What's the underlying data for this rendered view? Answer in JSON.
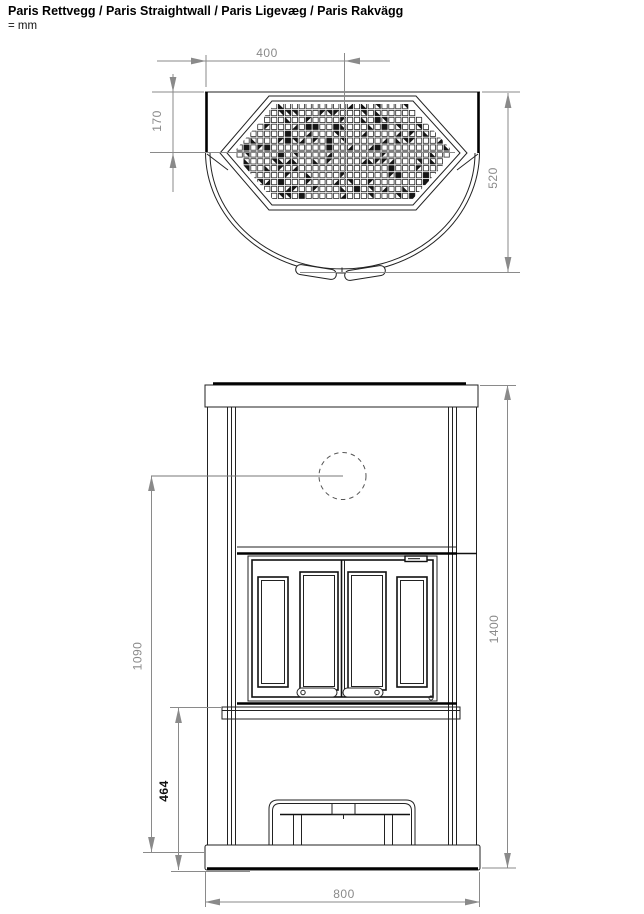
{
  "title": "Paris Rettvegg / Paris Straightwall / Paris Ligevæg / Paris Rakvägg",
  "unit_note": "= mm",
  "colors": {
    "background": "#ffffff",
    "drawing_line": "#222222",
    "thick_line": "#000000",
    "dimension": "#8a8a8a",
    "dimension_emphasis": "#101010"
  },
  "dims": {
    "center_offset": "400",
    "straight_side_depth": "170",
    "total_depth": "520",
    "flue_center_height": "1090",
    "base_section_height": "464",
    "total_height": "1400",
    "width": "800"
  },
  "grille": {
    "rows": 14,
    "cols": 31,
    "pitch": 6.9,
    "cell": 5.3,
    "x0": 237,
    "y0": 103.5
  }
}
